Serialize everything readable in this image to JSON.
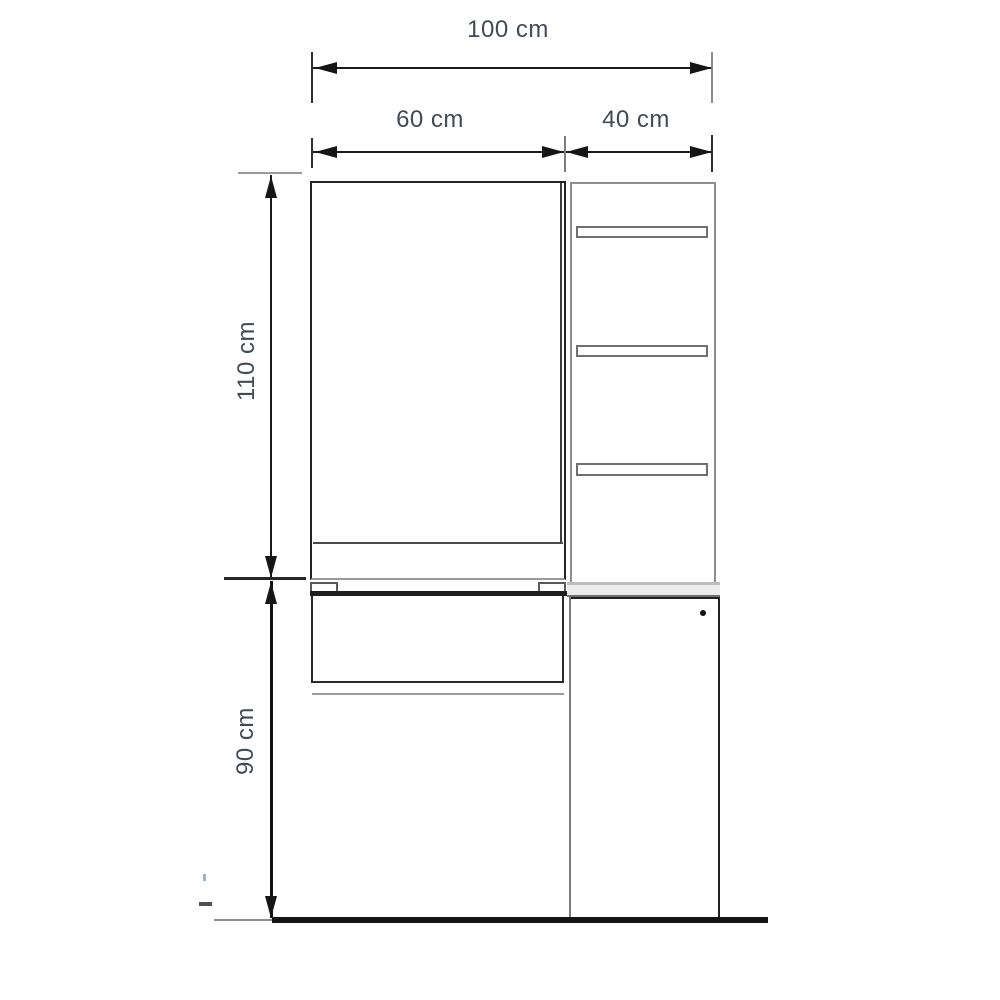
{
  "diagram": {
    "type": "furniture-dimension-drawing",
    "dimensions": {
      "total_width": "100 cm",
      "door_width": "60 cm",
      "side_width": "40 cm",
      "upper_height": "110 cm",
      "lower_height": "90 cm"
    },
    "parts": {
      "upper_door": "upper cabinet door (60 cm)",
      "shelf_unit": "upper side shelf unit (40 cm)",
      "drawer": "lower drawer front",
      "lower_door": "lower cabinet door",
      "floor": "floor line"
    },
    "colors": {
      "line_dark": "#1f1f1f",
      "line_grey": "#8f8f8f",
      "label_text": "#414b57",
      "background": "#ffffff"
    }
  }
}
